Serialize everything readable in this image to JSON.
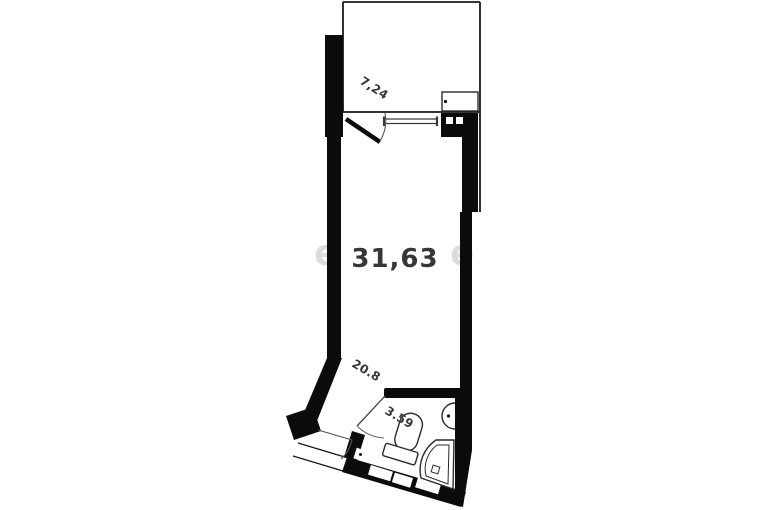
{
  "floorplan": {
    "rooms": [
      {
        "name": "balcony",
        "area": "7,24"
      },
      {
        "name": "main-room",
        "area": "31,63"
      },
      {
        "name": "hallway",
        "area": "20.8"
      },
      {
        "name": "bathroom",
        "area": "3.59"
      }
    ],
    "watermark": {
      "left": "e",
      "right": "e"
    },
    "colors": {
      "wall": "#0b0b0b",
      "thin_line": "#1a1a1a",
      "fixture": "#2a2a2a",
      "label": "#373737",
      "watermark": "#dcdcdc"
    }
  }
}
